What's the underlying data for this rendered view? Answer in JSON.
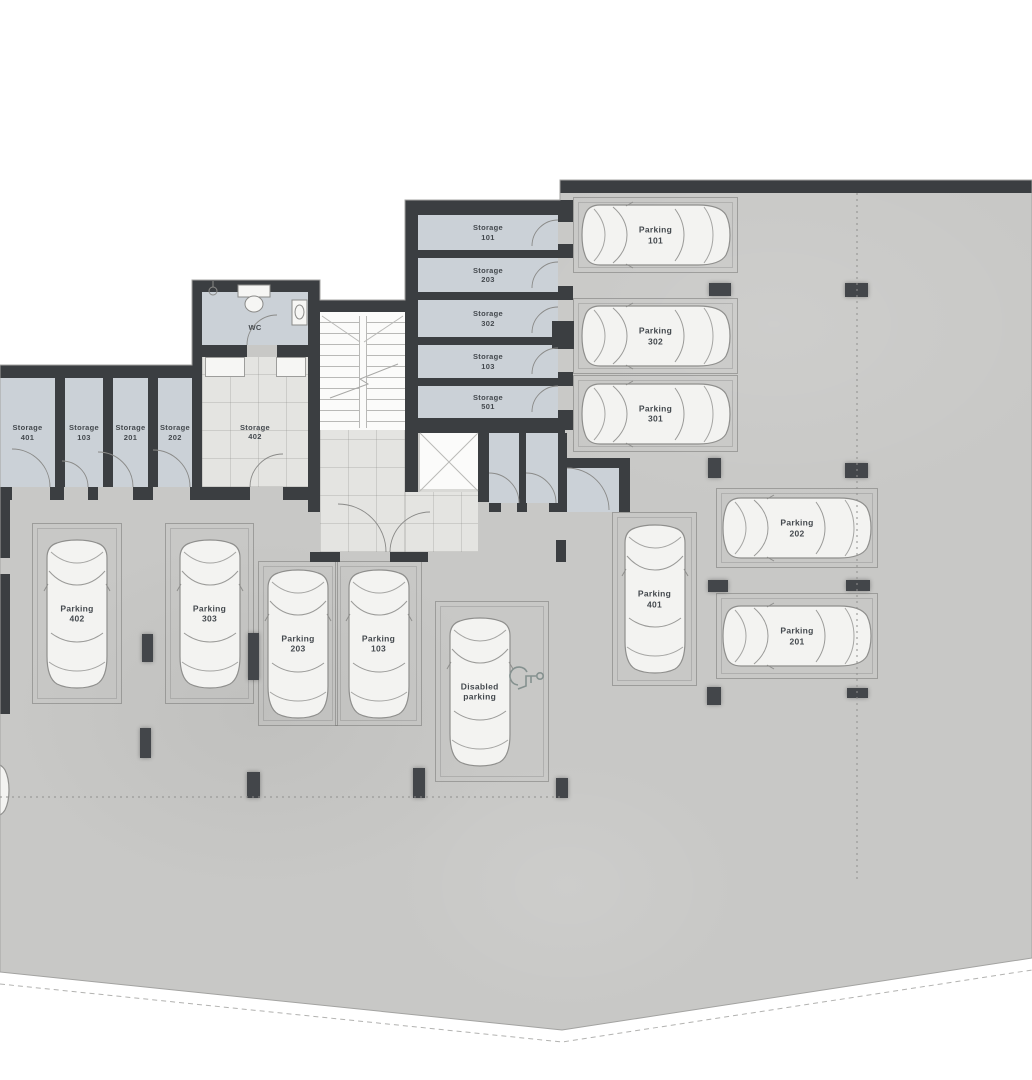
{
  "floorplan": {
    "rooms": {
      "wc": {
        "label": "WC"
      },
      "storage_402": {
        "line1": "Storage",
        "line2": "402"
      },
      "storage_left_row": [
        {
          "line1": "Storage",
          "line2": "401"
        },
        {
          "line1": "Storage",
          "line2": "103"
        },
        {
          "line1": "Storage",
          "line2": "201"
        },
        {
          "line1": "Storage",
          "line2": "202"
        }
      ],
      "storage_top_column": [
        {
          "line1": "Storage",
          "line2": "101"
        },
        {
          "line1": "Storage",
          "line2": "203"
        },
        {
          "line1": "Storage",
          "line2": "302"
        },
        {
          "line1": "Storage",
          "line2": "103"
        },
        {
          "line1": "Storage",
          "line2": "501"
        }
      ]
    },
    "parking": {
      "spaces": [
        {
          "line1": "Parking",
          "line2": "101",
          "orientation": "horizontal"
        },
        {
          "line1": "Parking",
          "line2": "302",
          "orientation": "horizontal"
        },
        {
          "line1": "Parking",
          "line2": "301",
          "orientation": "horizontal"
        },
        {
          "line1": "Parking",
          "line2": "202",
          "orientation": "horizontal"
        },
        {
          "line1": "Parking",
          "line2": "201",
          "orientation": "horizontal"
        },
        {
          "line1": "Parking",
          "line2": "401",
          "orientation": "vertical"
        },
        {
          "line1": "Parking",
          "line2": "402",
          "orientation": "vertical"
        },
        {
          "line1": "Parking",
          "line2": "303",
          "orientation": "vertical"
        },
        {
          "line1": "Parking",
          "line2": "203",
          "orientation": "vertical"
        },
        {
          "line1": "Parking",
          "line2": "103",
          "orientation": "vertical"
        },
        {
          "line1": "Disabled",
          "line2": "parking",
          "orientation": "vertical"
        }
      ]
    },
    "icons": {
      "disabled_parking": "wheelchair"
    },
    "colors": {
      "wall": "#3b3e41",
      "slab": "#c8c8c6",
      "storage_room": "#cbd1d7",
      "tile": "#e4e4e1",
      "stairwell": "#fbfbfa",
      "car_body": "#f3f3f1",
      "spot_line": "#9d9d9b",
      "label_text": "#44494e"
    }
  }
}
